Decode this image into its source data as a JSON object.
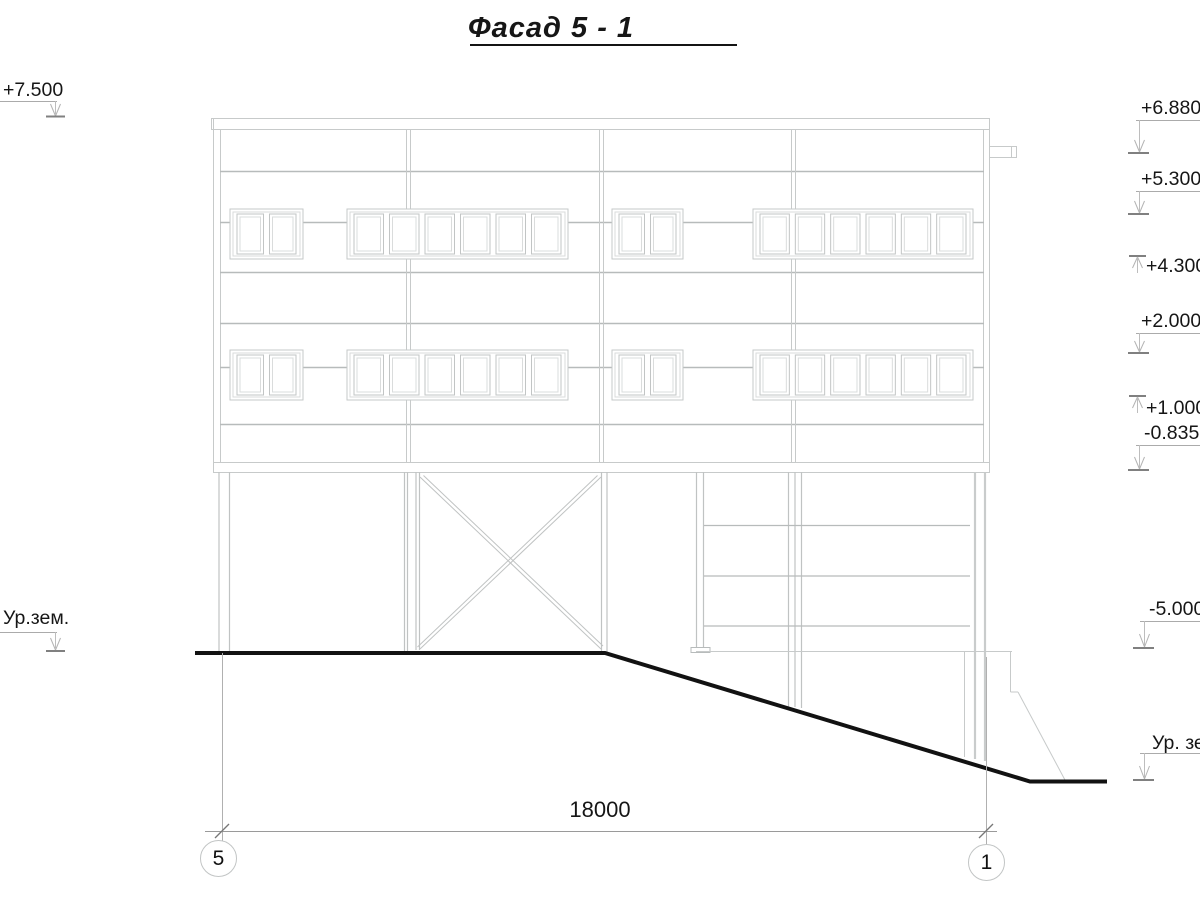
{
  "title": "Фасад 5 - 1",
  "marks": {
    "left": [
      {
        "label": "+7.500"
      },
      {
        "label": "Ур.зем."
      }
    ],
    "right": [
      {
        "label": "+6.880"
      },
      {
        "label": "+5.300"
      },
      {
        "label": "+4.300"
      },
      {
        "label": "+2.000"
      },
      {
        "label": "+1.000"
      },
      {
        "label": "-0.835"
      },
      {
        "label": "-5.000"
      },
      {
        "label": "Ур. зе"
      }
    ]
  },
  "dimension": {
    "length": "18000"
  },
  "axes": [
    {
      "label": "5"
    },
    {
      "label": "1"
    }
  ],
  "colors": {
    "line_light": "#c7caca",
    "line_band": "#b7bbbb",
    "ground": "#121212",
    "text": "#161616"
  }
}
